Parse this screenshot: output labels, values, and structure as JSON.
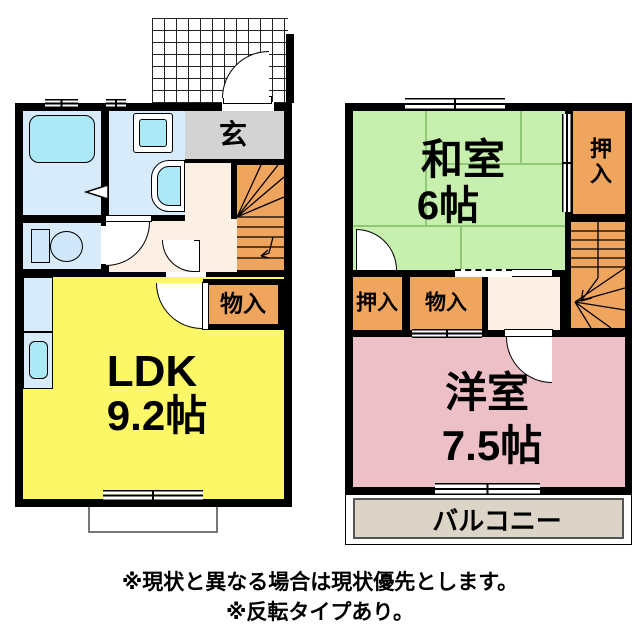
{
  "colors": {
    "wall": "#000000",
    "ldk_yellow": "#fbf766",
    "washitsu_green": "#c7efad",
    "yoshitsu_pink": "#edbfc6",
    "storage_orange": "#efa55e",
    "genkan_gray": "#d3d3d3",
    "hall_cream": "#fcefe3",
    "wet_area_blue": "#d8ebfa",
    "fixture_cyan": "#abe9f7",
    "balcony_beige": "#dbd4c7",
    "tatami_line_green": "#8fc977"
  },
  "floor1": {
    "genkan_label": "玄",
    "storage_label": "物入",
    "ldk_label": "LDK",
    "ldk_size": "9.2帖"
  },
  "floor2": {
    "washitsu_label": "和室",
    "washitsu_size": "6帖",
    "closet_top_label": "押入",
    "closet_bottom_label": "押入",
    "storage_label": "物入",
    "yoshitsu_label": "洋室",
    "yoshitsu_size": "7.5帖",
    "balcony_label": "バルコニー"
  },
  "notes": {
    "line1": "※現状と異なる場合は現状優先とします。",
    "line2": "※反転タイプあり。"
  }
}
